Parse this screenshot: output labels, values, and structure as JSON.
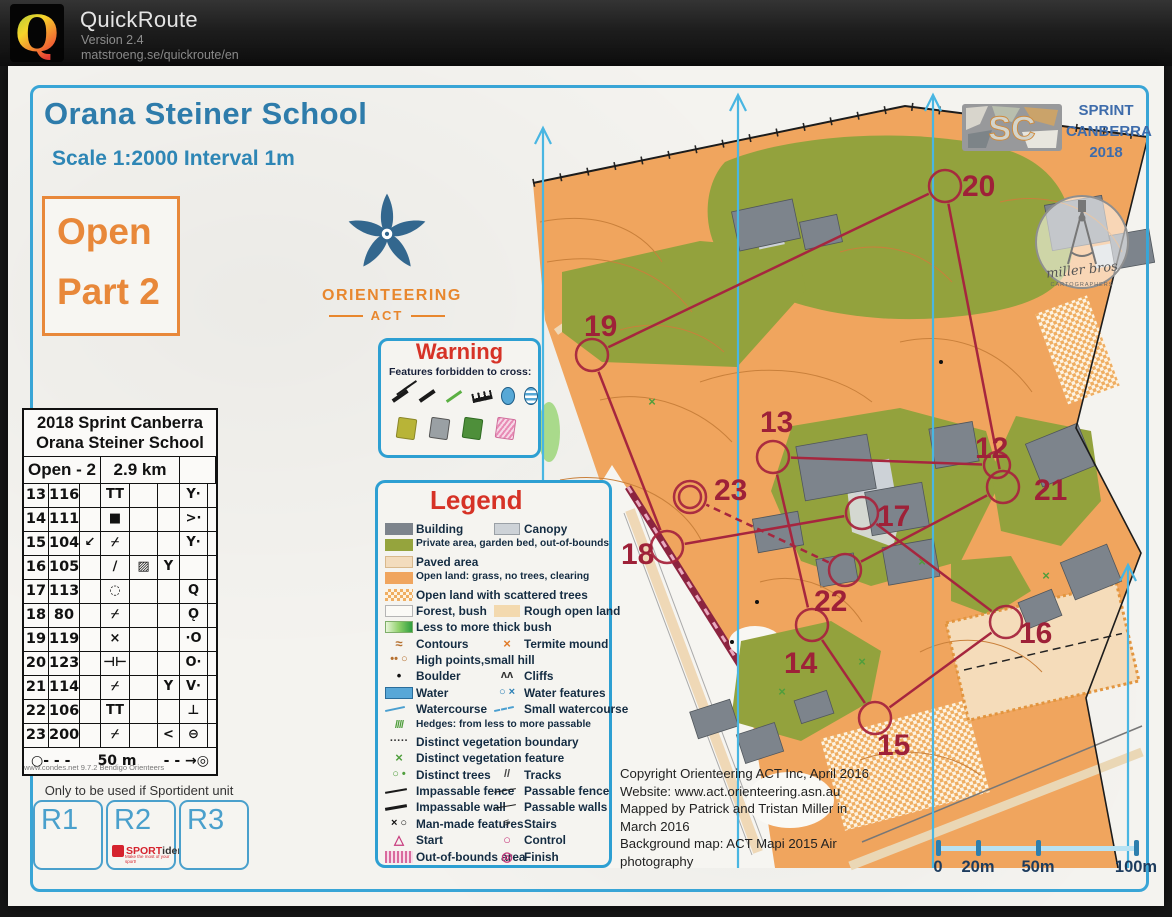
{
  "header": {
    "app": "QuickRoute",
    "version": "Version 2.4",
    "url": "matstroeng.se/quickroute/en",
    "logo_letter": "Q"
  },
  "colors": {
    "frame": "#39a5d6",
    "heading": "#2e7cab",
    "accent_orange": "#e8883a",
    "warning_red": "#d63226",
    "course": "#a6263e",
    "north_lines": "#49b6e2",
    "scalebar": "#2d7fae"
  },
  "map": {
    "title": "Orana Steiner School",
    "scale": "Scale 1:2000 Interval 1m",
    "course_box": [
      "Open",
      "Part 2"
    ],
    "club": {
      "name": "ORIENTEERING",
      "region": "ACT"
    },
    "event": {
      "logo": "SC",
      "lines": [
        "SPRINT",
        "CANBERRA",
        "2018"
      ]
    },
    "cartographer": {
      "name": "miller bros",
      "sub": "CARTOGRAPHERS"
    },
    "warning": {
      "title": "Warning",
      "subtitle": "Features forbidden to cross:",
      "row1": [
        "impassable-fence",
        "impassable-wall",
        "hedge",
        "cliff-comb",
        "water",
        "marsh"
      ],
      "row2": [
        "square-olive",
        "square-grey",
        "square-green",
        "square-pink"
      ]
    },
    "card": {
      "title1": "2018 Sprint Canberra",
      "title2": "Orana Steiner School",
      "course": "Open - 2",
      "length": "2.9 km",
      "rows": [
        [
          "13",
          "116",
          "",
          "TT",
          "",
          "",
          "Y·",
          ""
        ],
        [
          "14",
          "111",
          "",
          "■",
          "",
          "",
          ">·",
          ""
        ],
        [
          "15",
          "104",
          "↙",
          "⌿",
          "",
          "",
          "Y·",
          ""
        ],
        [
          "16",
          "105",
          "",
          "∕",
          "▨",
          "Y",
          "",
          ""
        ],
        [
          "17",
          "113",
          "",
          "◌",
          "",
          "",
          "Q",
          ""
        ],
        [
          "18",
          "80",
          "",
          "⌿",
          "",
          "",
          "Ǫ",
          ""
        ],
        [
          "19",
          "119",
          "",
          "×",
          "",
          "",
          "·O",
          ""
        ],
        [
          "20",
          "123",
          "",
          "⊣⊢",
          "",
          "",
          "O·",
          ""
        ],
        [
          "21",
          "114",
          "",
          "⌿",
          "",
          "Y",
          "V·",
          ""
        ],
        [
          "22",
          "106",
          "",
          "TT",
          "",
          "",
          "⊥",
          ""
        ],
        [
          "23",
          "200",
          "",
          "⌿",
          "",
          "<",
          "⊖",
          ""
        ]
      ],
      "footer_l": "○- - -",
      "footer_m": "50 m",
      "footer_r": "- - →◎",
      "attribution": "www.condes.net 9.7.2 Bendigo Orienteers"
    },
    "note": "Only to be used if Sportident unit fails",
    "rent": {
      "boxes": [
        "R1",
        "R2",
        "R3"
      ],
      "sportident": {
        "brand_bold": "SPORT",
        "brand_rest": "ident",
        "tagline": "Make the most of your sport!"
      }
    },
    "legend": {
      "title": "Legend",
      "rows": [
        {
          "l": {
            "i": "building",
            "t": "Building"
          },
          "r": {
            "i": "canopy",
            "t": "Canopy"
          }
        },
        {
          "l": {
            "i": "private",
            "t": "Private area, garden bed, out-of-bounds"
          }
        },
        {
          "l": {
            "i": "paved",
            "t": "Paved area"
          }
        },
        {
          "l": {
            "i": "open",
            "t": "Open land: grass, no trees, clearing"
          }
        },
        {
          "l": {
            "i": "scattered",
            "t": "Open land with scattered trees"
          }
        },
        {
          "l": {
            "i": "forest",
            "t": "Forest, bush"
          },
          "r": {
            "i": "rough",
            "t": "Rough open land"
          }
        },
        {
          "l": {
            "i": "thickbush",
            "t": "Less to more thick bush"
          }
        },
        {
          "l": {
            "i": "contours",
            "t": "Contours"
          },
          "r": {
            "i": "termite",
            "t": "Termite mound"
          }
        },
        {
          "l": {
            "i": "highpoints",
            "t": "High points,small hill"
          }
        },
        {
          "l": {
            "i": "boulder",
            "t": "Boulder"
          },
          "r": {
            "i": "cliffs",
            "t": "Cliffs"
          }
        },
        {
          "l": {
            "i": "water",
            "t": "Water"
          },
          "r": {
            "i": "waterfeat",
            "t": "Water features"
          }
        },
        {
          "l": {
            "i": "watercourse",
            "t": "Watercourse"
          },
          "r": {
            "i": "smallwater",
            "t": "Small watercourse"
          }
        },
        {
          "l": {
            "i": "hedges",
            "t": "Hedges: from less to more passable"
          }
        },
        {
          "l": {
            "i": "vegbound",
            "t": "Distinct vegetation boundary"
          }
        },
        {
          "l": {
            "i": "vegfeat",
            "t": "Distinct vegetation feature"
          }
        },
        {
          "l": {
            "i": "trees",
            "t": "Distinct trees"
          },
          "r": {
            "i": "tracks",
            "t": "Tracks"
          }
        },
        {
          "l": {
            "i": "impfence",
            "t": "Impassable fence"
          },
          "r": {
            "i": "passfence",
            "t": "Passable fence"
          }
        },
        {
          "l": {
            "i": "impwall",
            "t": "Impassable wall"
          },
          "r": {
            "i": "passwall",
            "t": "Passable walls"
          }
        },
        {
          "l": {
            "i": "manmade",
            "t": "Man-made features"
          },
          "r": {
            "i": "stairs",
            "t": "Stairs"
          }
        },
        {
          "l": {
            "i": "start",
            "t": "Start"
          },
          "r": {
            "i": "control",
            "t": "Control"
          }
        },
        {
          "l": {
            "i": "oob",
            "t": "Out-of-bounds area"
          },
          "r": {
            "i": "finish",
            "t": "Finish"
          }
        }
      ]
    },
    "copyright": [
      "Copyright Orienteering ACT Inc, April 2016",
      "Website: www.act.orienteering.asn.au",
      "Mapped by  Patrick and Tristan Miller in",
      "March 2016",
      "Background map: ACT Mapi 2015 Air",
      "photography"
    ],
    "scalebar": {
      "ticks": [
        {
          "label": "0",
          "x": 8
        },
        {
          "label": "20m",
          "x": 48
        },
        {
          "label": "50m",
          "x": 108
        },
        {
          "label": "100m",
          "x": 206
        }
      ]
    },
    "course": {
      "controls": [
        {
          "n": "12",
          "cx": 997,
          "cy": 465,
          "r": 13,
          "lx": 975,
          "ly": 458
        },
        {
          "n": "13",
          "cx": 773,
          "cy": 457,
          "r": 16,
          "lx": 760,
          "ly": 432
        },
        {
          "n": "14",
          "cx": 812,
          "cy": 625,
          "r": 16,
          "lx": 784,
          "ly": 673
        },
        {
          "n": "15",
          "cx": 875,
          "cy": 718,
          "r": 16,
          "lx": 877,
          "ly": 755
        },
        {
          "n": "16",
          "cx": 1006,
          "cy": 622,
          "r": 16,
          "lx": 1019,
          "ly": 643
        },
        {
          "n": "17",
          "cx": 862,
          "cy": 513,
          "r": 16,
          "lx": 877,
          "ly": 526
        },
        {
          "n": "18",
          "cx": 667,
          "cy": 547,
          "r": 16,
          "lx": 621,
          "ly": 564
        },
        {
          "n": "19",
          "cx": 592,
          "cy": 355,
          "r": 16,
          "lx": 584,
          "ly": 336
        },
        {
          "n": "20",
          "cx": 945,
          "cy": 186,
          "r": 16,
          "lx": 962,
          "ly": 196
        },
        {
          "n": "21",
          "cx": 1003,
          "cy": 487,
          "r": 16,
          "lx": 1034,
          "ly": 500
        },
        {
          "n": "22",
          "cx": 845,
          "cy": 570,
          "r": 16,
          "lx": 814,
          "ly": 611
        },
        {
          "n": "23",
          "cx": 690,
          "cy": 497,
          "r": 16,
          "r2": 11,
          "lx": 714,
          "ly": 500,
          "finish": true
        }
      ],
      "legs": [
        [
          "12",
          "13"
        ],
        [
          "13",
          "14"
        ],
        [
          "14",
          "15"
        ],
        [
          "15",
          "16"
        ],
        [
          "16",
          "17"
        ],
        [
          "17",
          "18"
        ],
        [
          "18",
          "19"
        ],
        [
          "19",
          "20"
        ],
        [
          "20",
          "21"
        ],
        [
          "21",
          "22"
        ]
      ],
      "dashed_legs": [
        [
          "22",
          "23"
        ]
      ]
    },
    "north_lines": [
      {
        "x": 543,
        "y1": 126,
        "y2": 868
      },
      {
        "x": 738,
        "y1": 93,
        "y2": 868
      },
      {
        "x": 933,
        "y1": 93,
        "y2": 868
      },
      {
        "x": 1128,
        "y1": 563,
        "y2": 868
      }
    ]
  }
}
